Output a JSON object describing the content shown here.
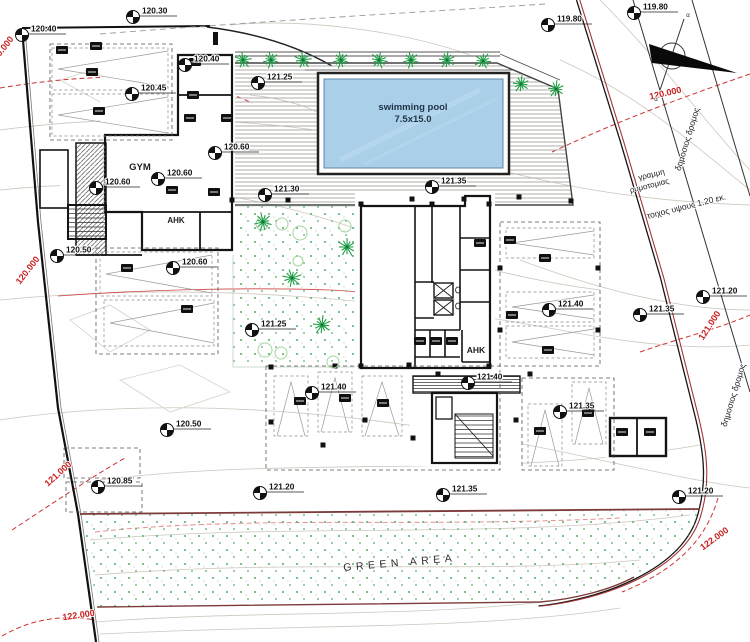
{
  "drawing": {
    "pool": {
      "line1": "swimming pool",
      "line2": "7.5x15.0"
    },
    "labels": {
      "gym": "GYM",
      "ahk": "AHK",
      "green_area": "GREEN AREA"
    },
    "greek_labels": [
      {
        "t": "γραμμη",
        "x": 652,
        "y": 177,
        "rot": -14,
        "s": 8
      },
      {
        "t": "ρυμοτομιας",
        "x": 650,
        "y": 188,
        "rot": -14,
        "s": 8
      },
      {
        "t": "τοιχος υψους 1.20 εκ.",
        "x": 687,
        "y": 209,
        "rot": -14,
        "s": 8.5
      },
      {
        "t": "δημοσιος δρομος",
        "x": 690,
        "y": 140,
        "rot": -73,
        "s": 8.5
      },
      {
        "t": "δημοσιος δρομος",
        "x": 736,
        "y": 396,
        "rot": -73,
        "s": 8.5
      },
      {
        "t": "α",
        "x": 688,
        "y": 17,
        "rot": 0,
        "s": 6
      },
      {
        "t": "α",
        "x": 656,
        "y": 101,
        "rot": 0,
        "s": 6
      }
    ],
    "contour_labels": [
      {
        "t": "120.000",
        "x": 666,
        "y": 96,
        "rot": -13
      },
      {
        "t": "120.000",
        "x": 4,
        "y": 52,
        "rot": -52
      },
      {
        "t": "120.000",
        "x": 30,
        "y": 272,
        "rot": -52
      },
      {
        "t": "121.000",
        "x": 60,
        "y": 476,
        "rot": -42
      },
      {
        "t": "121.000",
        "x": 712,
        "y": 327,
        "rot": -57
      },
      {
        "t": "122.000",
        "x": 79,
        "y": 618,
        "rot": -8
      },
      {
        "t": "122.000",
        "x": 716,
        "y": 541,
        "rot": -36
      }
    ],
    "spot_elevations": [
      {
        "x": 133,
        "y": 17,
        "v": "120.30"
      },
      {
        "x": 22,
        "y": 35,
        "v": "120.40"
      },
      {
        "x": 548,
        "y": 25,
        "v": "119.80"
      },
      {
        "x": 634,
        "y": 13,
        "v": "119.80"
      },
      {
        "x": 258,
        "y": 83,
        "v": "121.25"
      },
      {
        "x": 132,
        "y": 94,
        "v": "120.45"
      },
      {
        "x": 185,
        "y": 65,
        "v": "120.40"
      },
      {
        "x": 215,
        "y": 153,
        "v": "120.60"
      },
      {
        "x": 158,
        "y": 179,
        "v": "120.60"
      },
      {
        "x": 96,
        "y": 188,
        "v": "120.60"
      },
      {
        "x": 265,
        "y": 195,
        "v": "121.30"
      },
      {
        "x": 432,
        "y": 187,
        "v": "121.35"
      },
      {
        "x": 57,
        "y": 256,
        "v": "120.50"
      },
      {
        "x": 173,
        "y": 268,
        "v": "120.60"
      },
      {
        "x": 252,
        "y": 330,
        "v": "121.25"
      },
      {
        "x": 549,
        "y": 310,
        "v": "121.40"
      },
      {
        "x": 640,
        "y": 315,
        "v": "121.35"
      },
      {
        "x": 703,
        "y": 297,
        "v": "121.20"
      },
      {
        "x": 468,
        "y": 383,
        "v": "121.40"
      },
      {
        "x": 312,
        "y": 393,
        "v": "121.40"
      },
      {
        "x": 167,
        "y": 430,
        "v": "120.50"
      },
      {
        "x": 98,
        "y": 487,
        "v": "120.85"
      },
      {
        "x": 260,
        "y": 493,
        "v": "121.20"
      },
      {
        "x": 443,
        "y": 495,
        "v": "121.35"
      },
      {
        "x": 560,
        "y": 412,
        "v": "121.35"
      },
      {
        "x": 679,
        "y": 497,
        "v": "121.20"
      }
    ],
    "trees": {
      "top": [
        [
          243,
          60
        ],
        [
          271,
          60
        ],
        [
          303,
          60
        ],
        [
          341,
          60
        ],
        [
          379,
          60
        ],
        [
          411,
          60
        ],
        [
          447,
          60
        ],
        [
          483,
          61
        ],
        [
          521,
          84
        ],
        [
          556,
          89
        ]
      ],
      "garden": [
        [
          263,
          222
        ],
        [
          292,
          278
        ],
        [
          322,
          325
        ],
        [
          347,
          247
        ]
      ]
    },
    "bushes": [
      [
        300,
        233,
        7
      ],
      [
        282,
        224,
        6
      ],
      [
        262,
        224,
        6
      ],
      [
        345,
        226,
        6
      ],
      [
        298,
        261,
        5
      ],
      [
        265,
        350,
        7
      ],
      [
        281,
        353,
        6
      ],
      [
        333,
        362,
        6
      ]
    ],
    "chips": [
      [
        62,
        50
      ],
      [
        96,
        46
      ],
      [
        92,
        72
      ],
      [
        99,
        111
      ],
      [
        195,
        62
      ],
      [
        193,
        95
      ],
      [
        190,
        118
      ],
      [
        227,
        118
      ],
      [
        172,
        190
      ],
      [
        214,
        192
      ],
      [
        127,
        268
      ],
      [
        187,
        309
      ],
      [
        420,
        341
      ],
      [
        436,
        341
      ],
      [
        452,
        341
      ],
      [
        510,
        240
      ],
      [
        545,
        258
      ],
      [
        512,
        315
      ],
      [
        548,
        350
      ],
      [
        300,
        401
      ],
      [
        345,
        398
      ],
      [
        383,
        403
      ],
      [
        540,
        431
      ],
      [
        588,
        413
      ],
      [
        622,
        432
      ],
      [
        650,
        432
      ],
      [
        480,
        243
      ]
    ],
    "columns": [
      [
        232,
        200
      ],
      [
        288,
        200
      ],
      [
        412,
        199
      ],
      [
        464,
        199
      ],
      [
        519,
        197
      ],
      [
        571,
        201
      ],
      [
        361,
        204
      ],
      [
        432,
        204
      ],
      [
        489,
        204
      ],
      [
        361,
        366
      ],
      [
        489,
        366
      ],
      [
        271,
        367
      ],
      [
        335,
        366
      ],
      [
        409,
        365
      ],
      [
        271,
        422
      ],
      [
        323,
        445
      ],
      [
        365,
        420
      ],
      [
        413,
        438
      ],
      [
        516,
        420
      ],
      [
        438,
        374
      ],
      [
        530,
        374
      ],
      [
        500,
        268
      ],
      [
        500,
        330
      ],
      [
        598,
        268
      ],
      [
        598,
        330
      ]
    ],
    "lots": [
      [
        50,
        44,
        122,
        96
      ],
      [
        96,
        248,
        122,
        106
      ],
      [
        500,
        222,
        100,
        144
      ],
      [
        266,
        366,
        234,
        104
      ],
      [
        522,
        378,
        92,
        92
      ],
      [
        64,
        448,
        76,
        30
      ],
      [
        66,
        482,
        76,
        30
      ]
    ],
    "stalls": [
      {
        "x": 52,
        "y": 48,
        "w": 116,
        "h": 42,
        "dir": "left"
      },
      {
        "x": 52,
        "y": 94,
        "w": 116,
        "h": 42,
        "dir": "left"
      },
      {
        "x": 100,
        "y": 252,
        "w": 112,
        "h": 44,
        "dir": "left"
      },
      {
        "x": 104,
        "y": 300,
        "w": 110,
        "h": 46,
        "dir": "left"
      },
      {
        "x": 506,
        "y": 228,
        "w": 88,
        "h": 30,
        "dir": "left"
      },
      {
        "x": 506,
        "y": 292,
        "w": 88,
        "h": 30,
        "dir": "left"
      },
      {
        "x": 506,
        "y": 326,
        "w": 88,
        "h": 32,
        "dir": "left"
      },
      {
        "x": 274,
        "y": 376,
        "w": 34,
        "h": 60,
        "dir": "up"
      },
      {
        "x": 318,
        "y": 372,
        "w": 34,
        "h": 60,
        "dir": "up"
      },
      {
        "x": 362,
        "y": 376,
        "w": 40,
        "h": 60,
        "dir": "up"
      },
      {
        "x": 528,
        "y": 404,
        "w": 34,
        "h": 62,
        "dir": "up"
      },
      {
        "x": 572,
        "y": 382,
        "w": 34,
        "h": 62,
        "dir": "up"
      }
    ],
    "colors": {
      "contour_red": "#c81e1e",
      "tree_green": "#1f9e45",
      "stipple_green": "#55ad6d",
      "pool_fill": "#a9cfe9",
      "wall": "#141414",
      "maroon": "#7c3a3a"
    }
  }
}
